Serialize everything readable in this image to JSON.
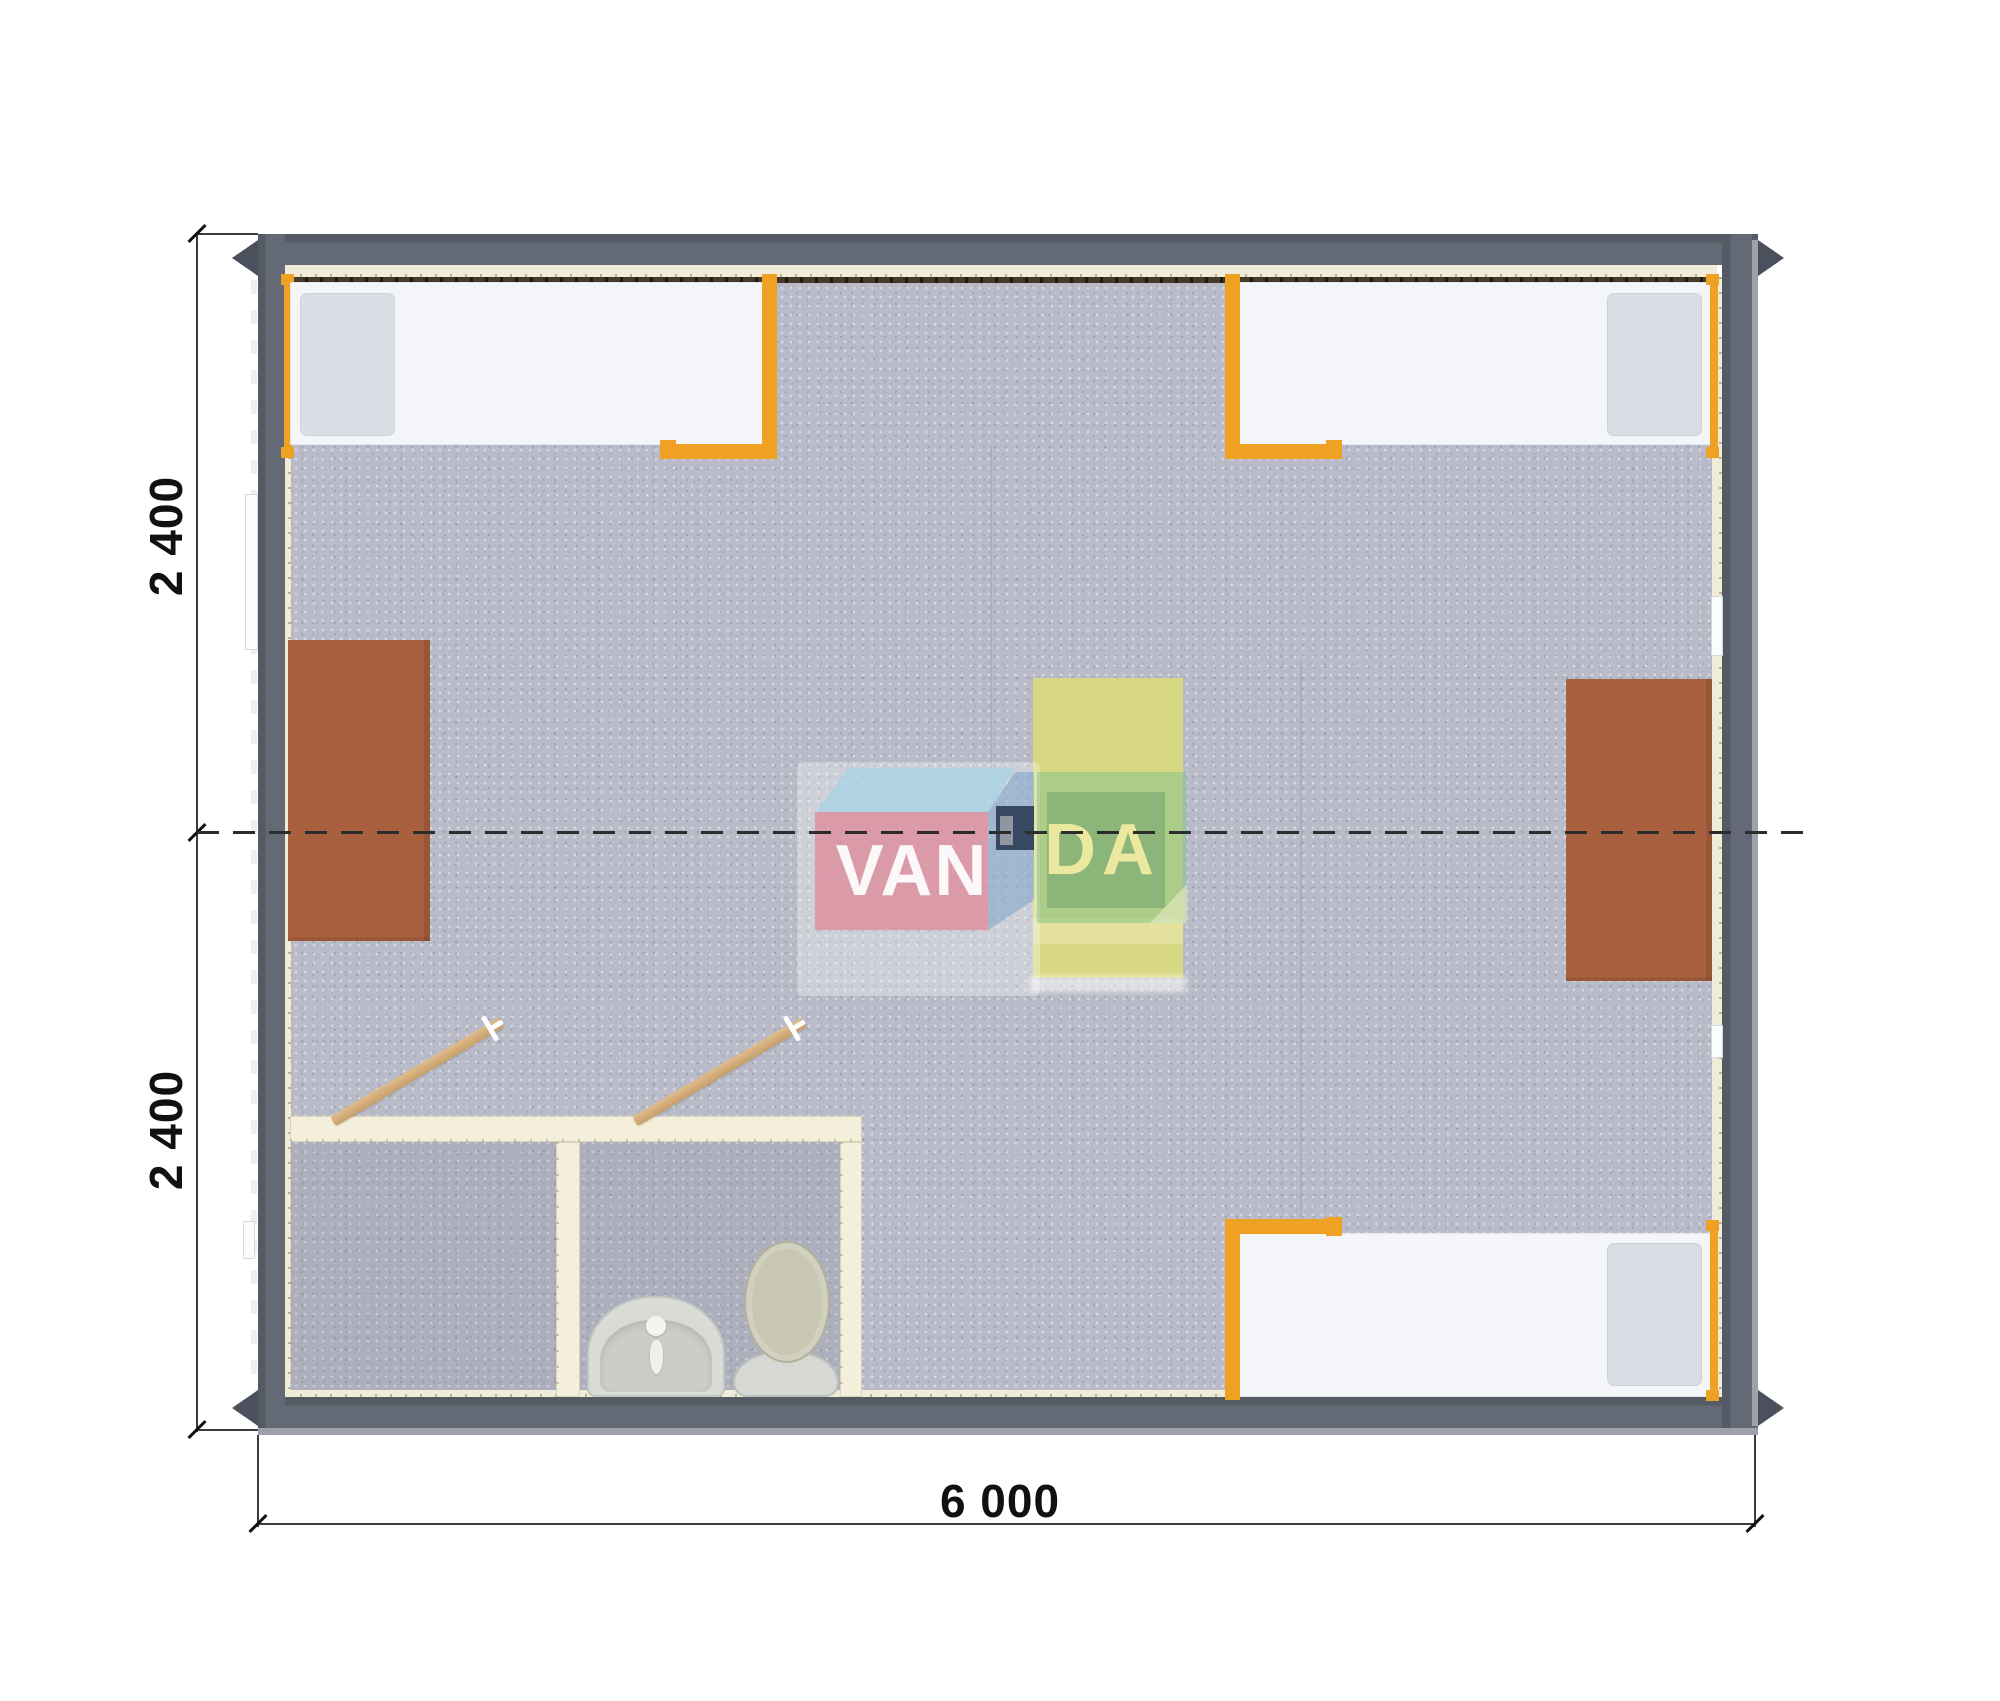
{
  "drawing": {
    "type": "floor-plan-top-view",
    "dimensions": {
      "left_upper": "2 400",
      "left_lower": "2 400",
      "bottom": "6 000"
    },
    "watermark": {
      "text_left": "VAN",
      "text_right": "DA",
      "colors": {
        "front_face": "#de8e9e",
        "top_face": "#a9d3e6",
        "side_face": "#7ba3c9",
        "cube": "#32425c",
        "green_overlay": "#7dc38c",
        "van_text": "#ffffff",
        "da_text": "#f0eca2"
      }
    },
    "palette": {
      "wall": "#5d6370",
      "wall_lip": "#9da1a9",
      "floor": "#b9bcc8",
      "liner": "#f0ecd8",
      "heater_strip": "#483a29",
      "accent_orange": "#efa124",
      "desk_brown": "#a8603e",
      "table_yellow": "#d8d783",
      "bath_wall": "#f3efdb",
      "door_wood": "#d2a877",
      "fixture_gray": "#d6d8d4",
      "dimension_text": "#111111"
    },
    "inventory": [
      {
        "item": "single-bed",
        "count": 3
      },
      {
        "item": "desk",
        "count": 2
      },
      {
        "item": "table",
        "count": 1
      },
      {
        "item": "toilet",
        "count": 1
      },
      {
        "item": "washbasin",
        "count": 1
      },
      {
        "item": "door-leaf",
        "count": 2
      },
      {
        "item": "window",
        "count": 4
      }
    ]
  }
}
